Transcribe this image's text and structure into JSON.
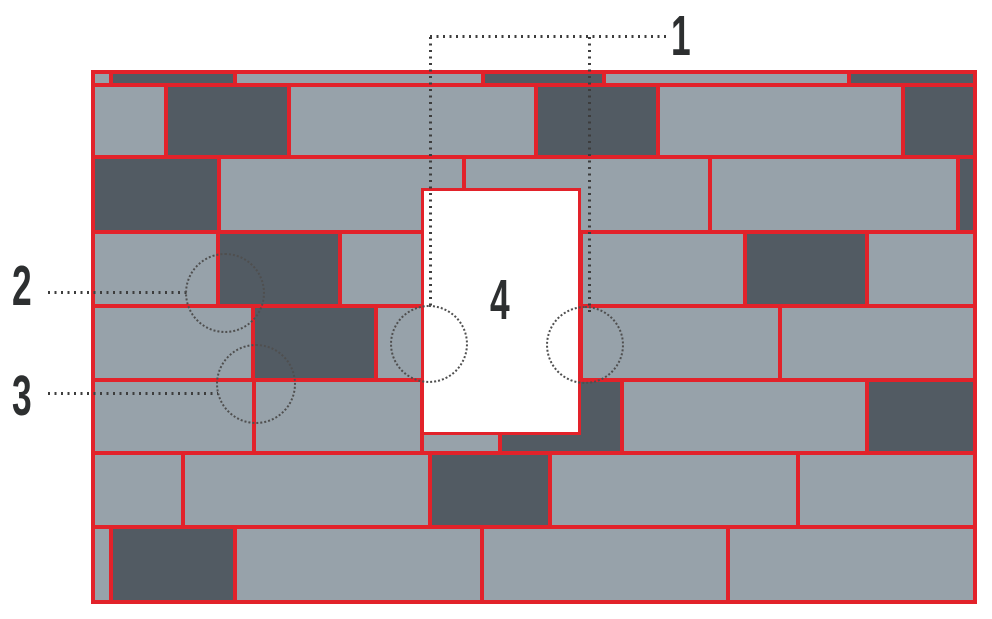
{
  "diagram": {
    "kind": "masonry-wall-elevation-with-window-opening",
    "background": "#ffffff"
  },
  "colors": {
    "stone_light": "#97a2aa",
    "stone_dark": "#525b63",
    "joint_red": "#e2222a",
    "window_white": "#ffffff",
    "callout_text": "#2d2f30",
    "dotted_line": "#3d3d3d",
    "dotted_circle": "#4f4f4f"
  },
  "wall": {
    "x": 91,
    "y": 70,
    "width": 886,
    "height": 534
  },
  "blocks": [
    {
      "x": 93,
      "y": 72,
      "w": 18,
      "h": 13,
      "shade": "light"
    },
    {
      "x": 111,
      "y": 72,
      "w": 124,
      "h": 13,
      "shade": "dark"
    },
    {
      "x": 235,
      "y": 72,
      "w": 248,
      "h": 13,
      "shade": "light"
    },
    {
      "x": 483,
      "y": 72,
      "w": 121,
      "h": 13,
      "shade": "dark"
    },
    {
      "x": 604,
      "y": 72,
      "w": 245,
      "h": 13,
      "shade": "light"
    },
    {
      "x": 849,
      "y": 72,
      "w": 126,
      "h": 13,
      "shade": "dark"
    },
    {
      "x": 93,
      "y": 85,
      "w": 73,
      "h": 72,
      "shade": "light"
    },
    {
      "x": 166,
      "y": 85,
      "w": 123,
      "h": 72,
      "shade": "dark"
    },
    {
      "x": 289,
      "y": 85,
      "w": 247,
      "h": 72,
      "shade": "light"
    },
    {
      "x": 536,
      "y": 85,
      "w": 122,
      "h": 72,
      "shade": "dark"
    },
    {
      "x": 658,
      "y": 85,
      "w": 245,
      "h": 72,
      "shade": "light"
    },
    {
      "x": 903,
      "y": 85,
      "w": 72,
      "h": 72,
      "shade": "dark"
    },
    {
      "x": 93,
      "y": 157,
      "w": 126,
      "h": 75,
      "shade": "dark"
    },
    {
      "x": 219,
      "y": 157,
      "w": 245,
      "h": 75,
      "shade": "light"
    },
    {
      "x": 464,
      "y": 157,
      "w": 246,
      "h": 75,
      "shade": "light"
    },
    {
      "x": 710,
      "y": 157,
      "w": 248,
      "h": 75,
      "shade": "light"
    },
    {
      "x": 958,
      "y": 157,
      "w": 17,
      "h": 75,
      "shade": "dark"
    },
    {
      "x": 93,
      "y": 232,
      "w": 125,
      "h": 74,
      "shade": "light"
    },
    {
      "x": 218,
      "y": 232,
      "w": 122,
      "h": 74,
      "shade": "dark"
    },
    {
      "x": 340,
      "y": 232,
      "w": 241,
      "h": 74,
      "shade": "light"
    },
    {
      "x": 581,
      "y": 232,
      "w": 164,
      "h": 74,
      "shade": "light"
    },
    {
      "x": 745,
      "y": 232,
      "w": 122,
      "h": 74,
      "shade": "dark"
    },
    {
      "x": 867,
      "y": 232,
      "w": 108,
      "h": 74,
      "shade": "light"
    },
    {
      "x": 93,
      "y": 306,
      "w": 160,
      "h": 74,
      "shade": "light"
    },
    {
      "x": 253,
      "y": 306,
      "w": 123,
      "h": 74,
      "shade": "dark"
    },
    {
      "x": 376,
      "y": 306,
      "w": 205,
      "h": 74,
      "shade": "light"
    },
    {
      "x": 581,
      "y": 306,
      "w": 199,
      "h": 74,
      "shade": "light"
    },
    {
      "x": 780,
      "y": 306,
      "w": 195,
      "h": 74,
      "shade": "light"
    },
    {
      "x": 93,
      "y": 380,
      "w": 161,
      "h": 73,
      "shade": "light"
    },
    {
      "x": 254,
      "y": 380,
      "w": 168,
      "h": 73,
      "shade": "light"
    },
    {
      "x": 422,
      "y": 380,
      "w": 78,
      "h": 73,
      "shade": "light"
    },
    {
      "x": 500,
      "y": 380,
      "w": 122,
      "h": 73,
      "shade": "dark"
    },
    {
      "x": 622,
      "y": 380,
      "w": 245,
      "h": 73,
      "shade": "light"
    },
    {
      "x": 867,
      "y": 380,
      "w": 108,
      "h": 73,
      "shade": "dark"
    },
    {
      "x": 93,
      "y": 453,
      "w": 90,
      "h": 74,
      "shade": "light"
    },
    {
      "x": 183,
      "y": 453,
      "w": 247,
      "h": 74,
      "shade": "light"
    },
    {
      "x": 430,
      "y": 453,
      "w": 120,
      "h": 74,
      "shade": "dark"
    },
    {
      "x": 550,
      "y": 453,
      "w": 248,
      "h": 74,
      "shade": "light"
    },
    {
      "x": 798,
      "y": 453,
      "w": 177,
      "h": 74,
      "shade": "light"
    },
    {
      "x": 93,
      "y": 527,
      "w": 18,
      "h": 75,
      "shade": "light"
    },
    {
      "x": 111,
      "y": 527,
      "w": 124,
      "h": 75,
      "shade": "dark"
    },
    {
      "x": 235,
      "y": 527,
      "w": 247,
      "h": 75,
      "shade": "light"
    },
    {
      "x": 482,
      "y": 527,
      "w": 246,
      "h": 75,
      "shade": "light"
    },
    {
      "x": 728,
      "y": 527,
      "w": 247,
      "h": 75,
      "shade": "light"
    }
  ],
  "window_opening": {
    "x": 421,
    "y": 188,
    "width": 160,
    "height": 247
  },
  "callouts": [
    {
      "id": "1",
      "label": "1",
      "label_x": 671,
      "label_y": 8
    },
    {
      "id": "2",
      "label": "2",
      "label_x": 12,
      "label_y": 258
    },
    {
      "id": "3",
      "label": "3",
      "label_x": 12,
      "label_y": 368
    },
    {
      "id": "4",
      "label": "4",
      "label_x": 490,
      "label_y": 272
    }
  ],
  "leader_lines": [
    {
      "callout": "1",
      "orientation": "h",
      "x": 430,
      "y": 35,
      "length": 236
    },
    {
      "callout": "1",
      "orientation": "v",
      "x": 429,
      "y": 37,
      "length": 269
    },
    {
      "callout": "1",
      "orientation": "v",
      "x": 588,
      "y": 37,
      "length": 279
    },
    {
      "callout": "2",
      "orientation": "h",
      "x": 48,
      "y": 291,
      "length": 142
    },
    {
      "callout": "3",
      "orientation": "h",
      "x": 48,
      "y": 392,
      "length": 170
    }
  ],
  "detail_circles": [
    {
      "callout": "2",
      "cx": 225,
      "cy": 293,
      "r": 40
    },
    {
      "callout": "3",
      "cx": 256,
      "cy": 384,
      "r": 40
    },
    {
      "callout": "4",
      "cx": 429,
      "cy": 344,
      "r": 39
    },
    {
      "callout": "4",
      "cx": 585,
      "cy": 345,
      "r": 39
    }
  ]
}
